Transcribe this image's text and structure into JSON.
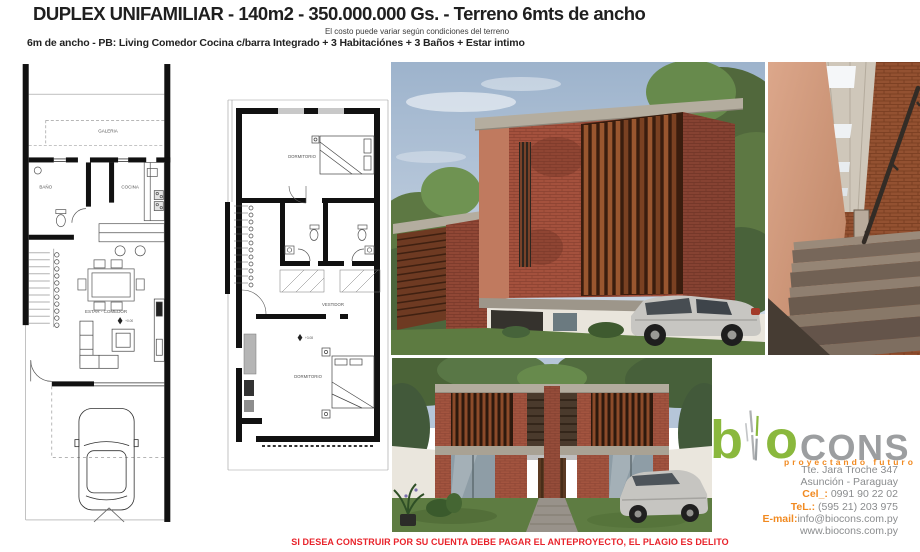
{
  "header": {
    "title": "DUPLEX  UNIFAMILIAR  - 140m2 - 350.000.000 Gs. - Terreno 6mts de ancho",
    "subtitle": "El costo puede variar según condiciones del terreno",
    "line2": "6m de ancho - PB: Living Comedor Cocina c/barra Integrado + 3 Habitaciónes + 3 Baños + Estar intimo"
  },
  "plans": {
    "ground": {
      "galeria": "GALERIA",
      "bano": "BAÑO",
      "cocina": "COCINA",
      "estar": "ESTAR - COMEDOR",
      "level": "+0.00"
    },
    "upper": {
      "dormitorio_top": "DORMITORIO",
      "vestidor": "VESTIDOR",
      "dormitorio_main": "DORMITORIO",
      "level": "+3.08"
    }
  },
  "brand": {
    "logo_b": "b",
    "logo_o": "o",
    "logo_cons": "CONS",
    "tagline": "proyectando futuro",
    "address_line1": "Tte. Jara Troche 347",
    "address_line2": "Asunción - Paraguay",
    "cel_label": "Cel_:",
    "cel_value": " 0991 90 22 02",
    "tel_label": "TeL.:",
    "tel_value": " (595 21) 203 975",
    "email_label": "E-mail:",
    "email_value": "info@biocons.com.py",
    "website": "www.biocons.com.py",
    "colors": {
      "green": "#8ab83d",
      "gray": "#9c9ea0",
      "orange": "#f18a21"
    }
  },
  "footer": {
    "disclaimer": "SI DESEA CONSTRUIR POR SU CUENTA DEBE PAGAR EL ANTEPROYECTO, EL PLAGIO ES DELITO",
    "color": "#e8232b"
  }
}
